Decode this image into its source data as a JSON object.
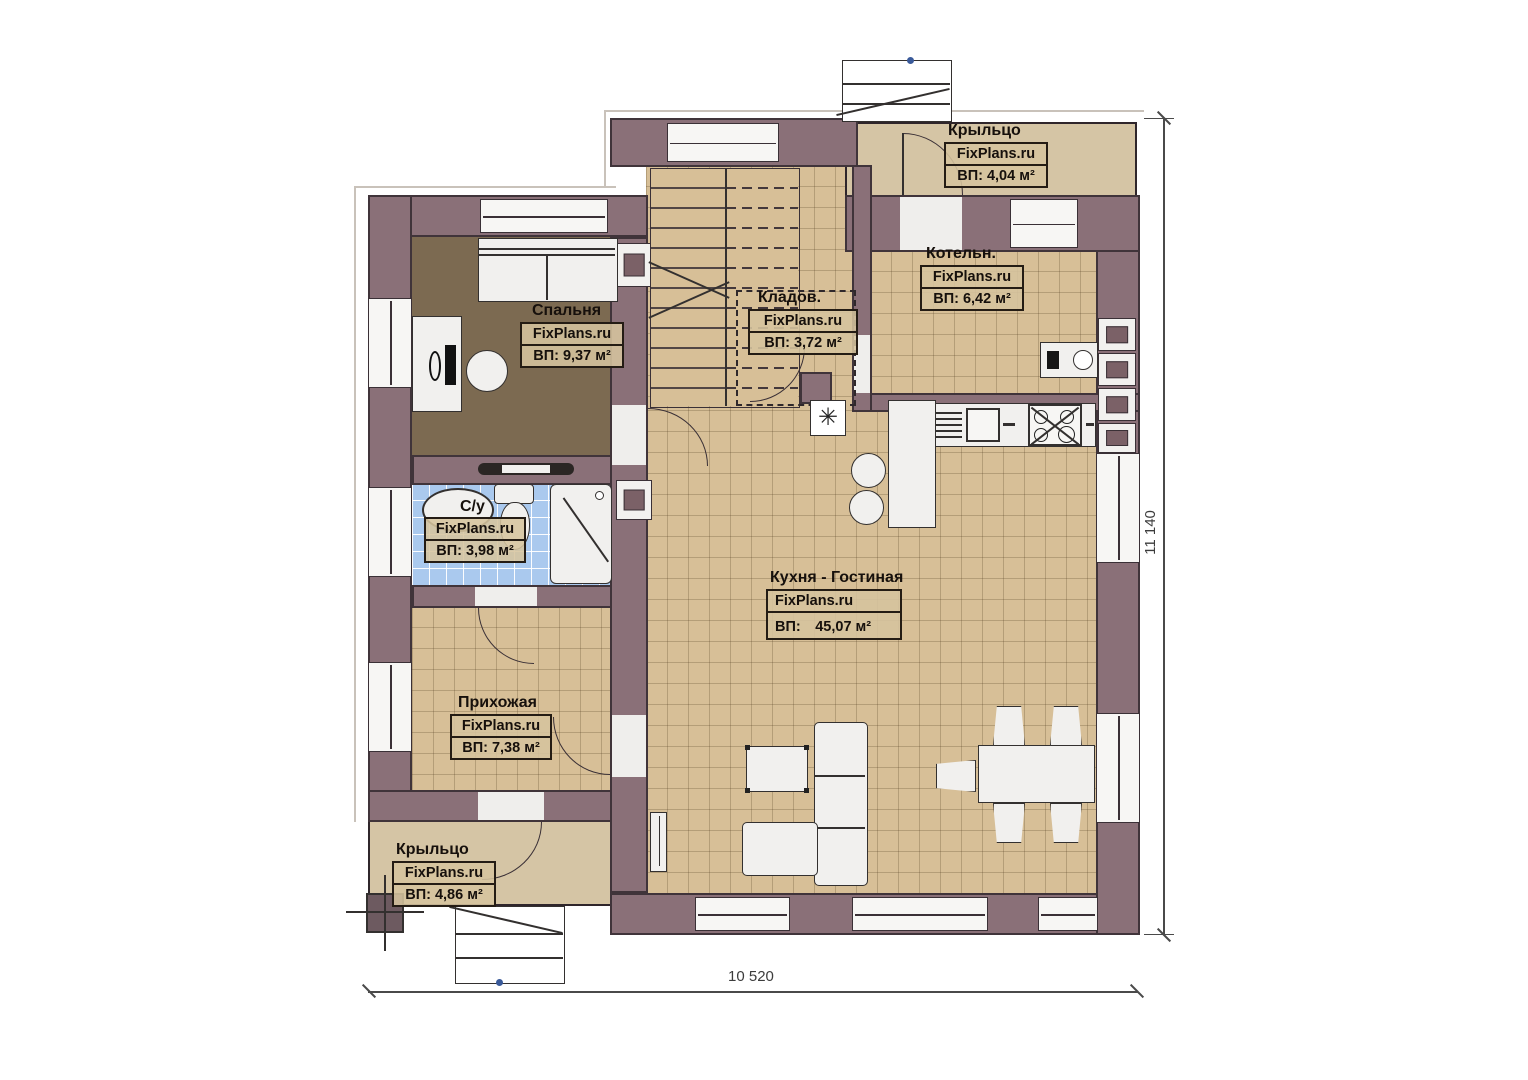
{
  "plan": {
    "rooms": [
      {
        "id": "bedroom",
        "name": "Спальня",
        "brand": "FixPlans.ru",
        "area_label": "ВП: 9,37 м²"
      },
      {
        "id": "storage",
        "name": "Кладов.",
        "brand": "FixPlans.ru",
        "area_label": "ВП: 3,72 м²"
      },
      {
        "id": "boiler",
        "name": "Котельн.",
        "brand": "FixPlans.ru",
        "area_label": "ВП: 6,42 м²"
      },
      {
        "id": "porch_top",
        "name": "Крыльцо",
        "brand": "FixPlans.ru",
        "area_label": "ВП: 4,04 м²"
      },
      {
        "id": "bathroom",
        "name": "С/у",
        "brand": "FixPlans.ru",
        "area_label": "ВП: 3,98 м²"
      },
      {
        "id": "kitchen_living",
        "name": "Кухня - Гостиная",
        "brand": "FixPlans.ru",
        "area_label": "ВП:　45,07 м²"
      },
      {
        "id": "hallway",
        "name": "Прихожая",
        "brand": "FixPlans.ru",
        "area_label": "ВП: 7,38 м²"
      },
      {
        "id": "porch_bottom",
        "name": "Крыльцо",
        "brand": "FixPlans.ru",
        "area_label": "ВП: 4,86 м²"
      }
    ],
    "dimensions": {
      "bottom": "10 520",
      "right": "11 140"
    },
    "symbols": {
      "stove_star": "✳"
    },
    "colors": {
      "wall": "#8a7078",
      "floor_tile": "#d7bf97",
      "bath_tile": "#aac9ee",
      "porch": "#d5c5a5",
      "bedroom_floor": "#7c6a51",
      "outline": "#40343a"
    }
  }
}
